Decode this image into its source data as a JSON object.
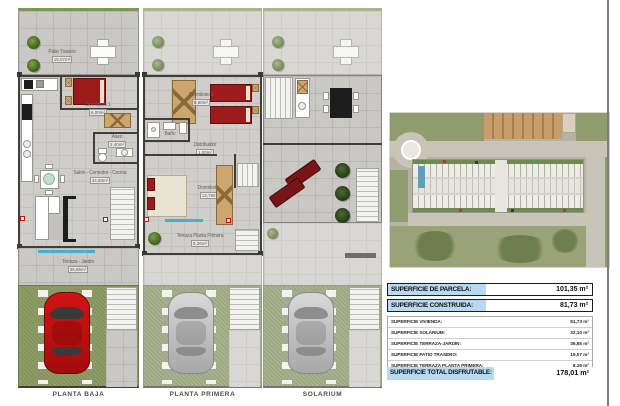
{
  "colors": {
    "table_highlight": "#b9d9f0",
    "car_red": "#d31313",
    "bed_red": "#9e1b1b",
    "grass_green": "#8e9c66",
    "terrace_blue": "#49aec9"
  },
  "plans": {
    "baja": {
      "title": "PLANTA BAJA",
      "patio_label": "Patio Trasero",
      "patio_area": "19,07m²",
      "dorm1_label": "Dormitorio 1",
      "dorm1_area": "6,00m²",
      "aseo_label": "Aseo",
      "aseo_area": "2,40m²",
      "salon_label": "Salón - Comedor - Cocina",
      "salon_area": "34,50m²",
      "terraza_label": "Terraza - Jardín",
      "terraza_area": "36,85m²"
    },
    "primera": {
      "title": "PLANTA PRIMERA",
      "dorm2_label": "Dormitorio 2",
      "dorm2_area": "8,60m²",
      "bano_label": "Baño",
      "bano_area": "3,70m²",
      "distribuidor_label": "Distribuidor",
      "distribuidor_area": "1,00m²",
      "dorm3_label": "Dormitorio 3",
      "dorm3_area": "13,79m²",
      "terraza_label": "Terraza Planta Primera",
      "terraza_area": "8,26m²"
    },
    "solarium": {
      "title": "SOLARIUM"
    }
  },
  "table": {
    "parcela_label": "SUPERFICIE DE PARCELA:",
    "parcela_value": "101,35 m²",
    "construida_label": "SUPERFICIE CONSTRUIDA:",
    "construida_value": "81,73 m²",
    "details": [
      {
        "label": "SUPERFICIE VIVIENDA:",
        "value": "81,73 m²"
      },
      {
        "label": "SUPERFICIE SOLARIUM:",
        "value": "32,10 m²"
      },
      {
        "label": "SUPERFICIE TERRAZA-JARDÍN:",
        "value": "36,85 m²"
      },
      {
        "label": "SUPERFICIE PATIO TRASERO:",
        "value": "19,07 m²"
      },
      {
        "label": "SUPERFICIE TERRAZA PLANTA PRIMERA:",
        "value": "8,26 m²"
      }
    ],
    "total_label": "SUPERFICIE TOTAL DISFRUTABLE:",
    "total_value": "178,01 m²"
  }
}
